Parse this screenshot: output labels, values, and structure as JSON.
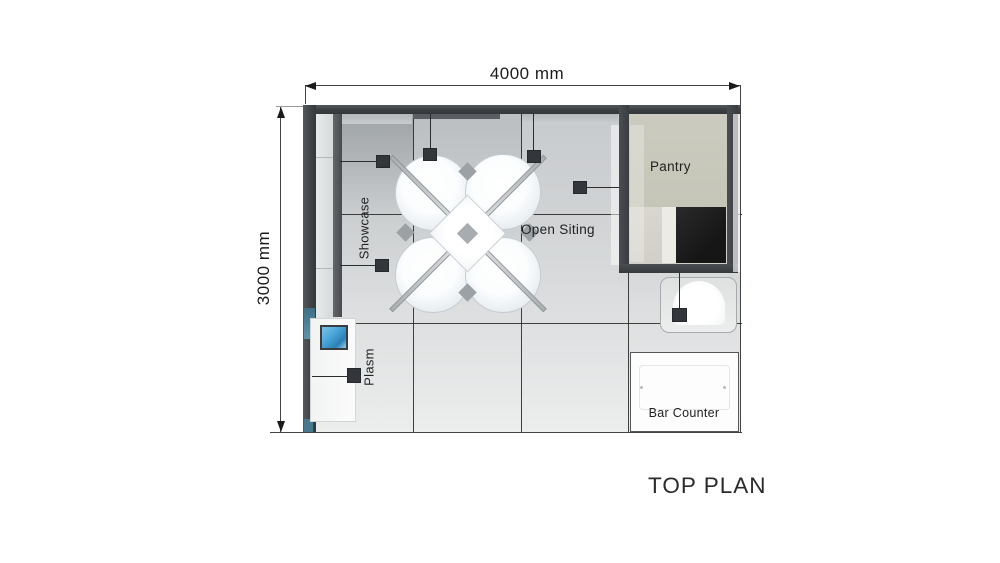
{
  "title": "TOP PLAN",
  "dimensions": {
    "width": "4000 mm",
    "height": "3000 mm"
  },
  "labels": {
    "showcase": "Showcase",
    "open_sitting": "Open Siting",
    "pantry": "Pantry",
    "plasma": "Plasm",
    "bar_counter": "Bar Counter"
  },
  "colors": {
    "wall": "#3e4144",
    "floor_light": "#e9eaea",
    "floor_dark": "#b7bbbd",
    "pantry_floor": "#c9c9bc",
    "counter_black": "#1d1d1d",
    "marker": "#33363a",
    "accent_teal": "#3f7085",
    "tv_blue": "#4aa7d8",
    "line": "#1c1c1c"
  }
}
